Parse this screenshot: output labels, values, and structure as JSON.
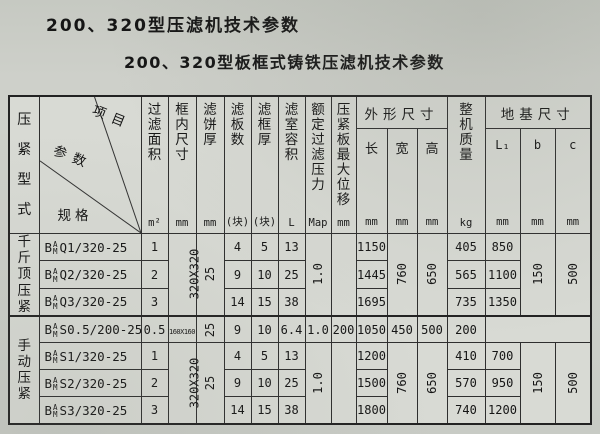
{
  "page": {
    "title1": "200、320型压滤机技术参数",
    "title2": "200、320型板框式铸铁压滤机技术参数",
    "bg_color": "#cbcec8",
    "border_color": "#2e2e2e"
  },
  "table": {
    "press_type_label": "压紧型式",
    "corner": {
      "item": "项目",
      "param": "参数",
      "spec": "规格"
    },
    "columns": {
      "area": {
        "label": "过滤面积",
        "unit": "m²"
      },
      "frame_inner": {
        "label": "框内尺寸",
        "unit": "mm"
      },
      "cake": {
        "label": "滤饼厚",
        "unit": "mm"
      },
      "plates": {
        "label": "滤板数",
        "unit": "(块)"
      },
      "frame_thick": {
        "label": "滤框厚",
        "unit": "(块)"
      },
      "volume": {
        "label": "滤室容积",
        "unit": "L"
      },
      "pressure": {
        "label": "额定过滤压力",
        "unit": "Map"
      },
      "displacement": {
        "label": "压紧板最大位移",
        "unit": "mm"
      },
      "overall": {
        "label": "外形尺寸",
        "length": {
          "label": "长",
          "unit": "mm"
        },
        "width": {
          "label": "宽",
          "unit": "mm"
        },
        "height": {
          "label": "高",
          "unit": "mm"
        }
      },
      "weight": {
        "label": "整机质量",
        "unit": "kg"
      },
      "foundation": {
        "label": "地基尺寸",
        "l1": {
          "label": "L₁",
          "unit": "mm"
        },
        "b": {
          "label": "b",
          "unit": "mm"
        },
        "c": {
          "label": "c",
          "unit": "mm"
        }
      }
    },
    "groups": [
      {
        "label": "千斤顶压紧",
        "merged": {
          "frame_inner": "320X320",
          "cake": "25",
          "pressure": "1.0",
          "width": "760",
          "height": "650",
          "b": "150",
          "c": "500"
        }
      },
      {
        "label": "手动压紧",
        "merged": {
          "frame_inner": "320X320",
          "cake": "25",
          "pressure": "1.0",
          "width": "760",
          "height": "650",
          "b": "150",
          "c": "500"
        }
      }
    ],
    "rows": [
      {
        "model_pre": "B",
        "model_sup": "A",
        "model_sub": "M",
        "model_code": "Q1/320-25",
        "area": "1",
        "plates": "4",
        "frame_thick": "5",
        "volume": "13",
        "length": "1150",
        "weight": "405",
        "l1": "850"
      },
      {
        "model_pre": "B",
        "model_sup": "A",
        "model_sub": "M",
        "model_code": "Q2/320-25",
        "area": "2",
        "plates": "9",
        "frame_thick": "10",
        "volume": "25",
        "length": "1445",
        "weight": "565",
        "l1": "1100"
      },
      {
        "model_pre": "B",
        "model_sup": "A",
        "model_sub": "M",
        "model_code": "Q3/320-25",
        "area": "3",
        "plates": "14",
        "frame_thick": "15",
        "volume": "38",
        "length": "1695",
        "weight": "735",
        "l1": "1350"
      },
      {
        "model_pre": "B",
        "model_sup": "A",
        "model_sub": "M",
        "model_code": "S0.5/200-25",
        "area": "0.5",
        "frame_inner": "160X160",
        "cake": "25",
        "plates": "9",
        "frame_thick": "10",
        "volume": "6.4",
        "pressure": "1.0",
        "displacement": "200",
        "length": "1050",
        "width": "450",
        "height": "500",
        "weight": "200"
      },
      {
        "model_pre": "B",
        "model_sup": "A",
        "model_sub": "M",
        "model_code": "S1/320-25",
        "area": "1",
        "plates": "4",
        "frame_thick": "5",
        "volume": "13",
        "length": "1200",
        "weight": "410",
        "l1": "700"
      },
      {
        "model_pre": "B",
        "model_sup": "A",
        "model_sub": "M",
        "model_code": "S2/320-25",
        "area": "2",
        "plates": "9",
        "frame_thick": "10",
        "volume": "25",
        "length": "1500",
        "weight": "570",
        "l1": "950"
      },
      {
        "model_pre": "B",
        "model_sup": "A",
        "model_sub": "M",
        "model_code": "S3/320-25",
        "area": "3",
        "plates": "14",
        "frame_thick": "15",
        "volume": "38",
        "length": "1800",
        "weight": "740",
        "l1": "1200"
      }
    ]
  }
}
